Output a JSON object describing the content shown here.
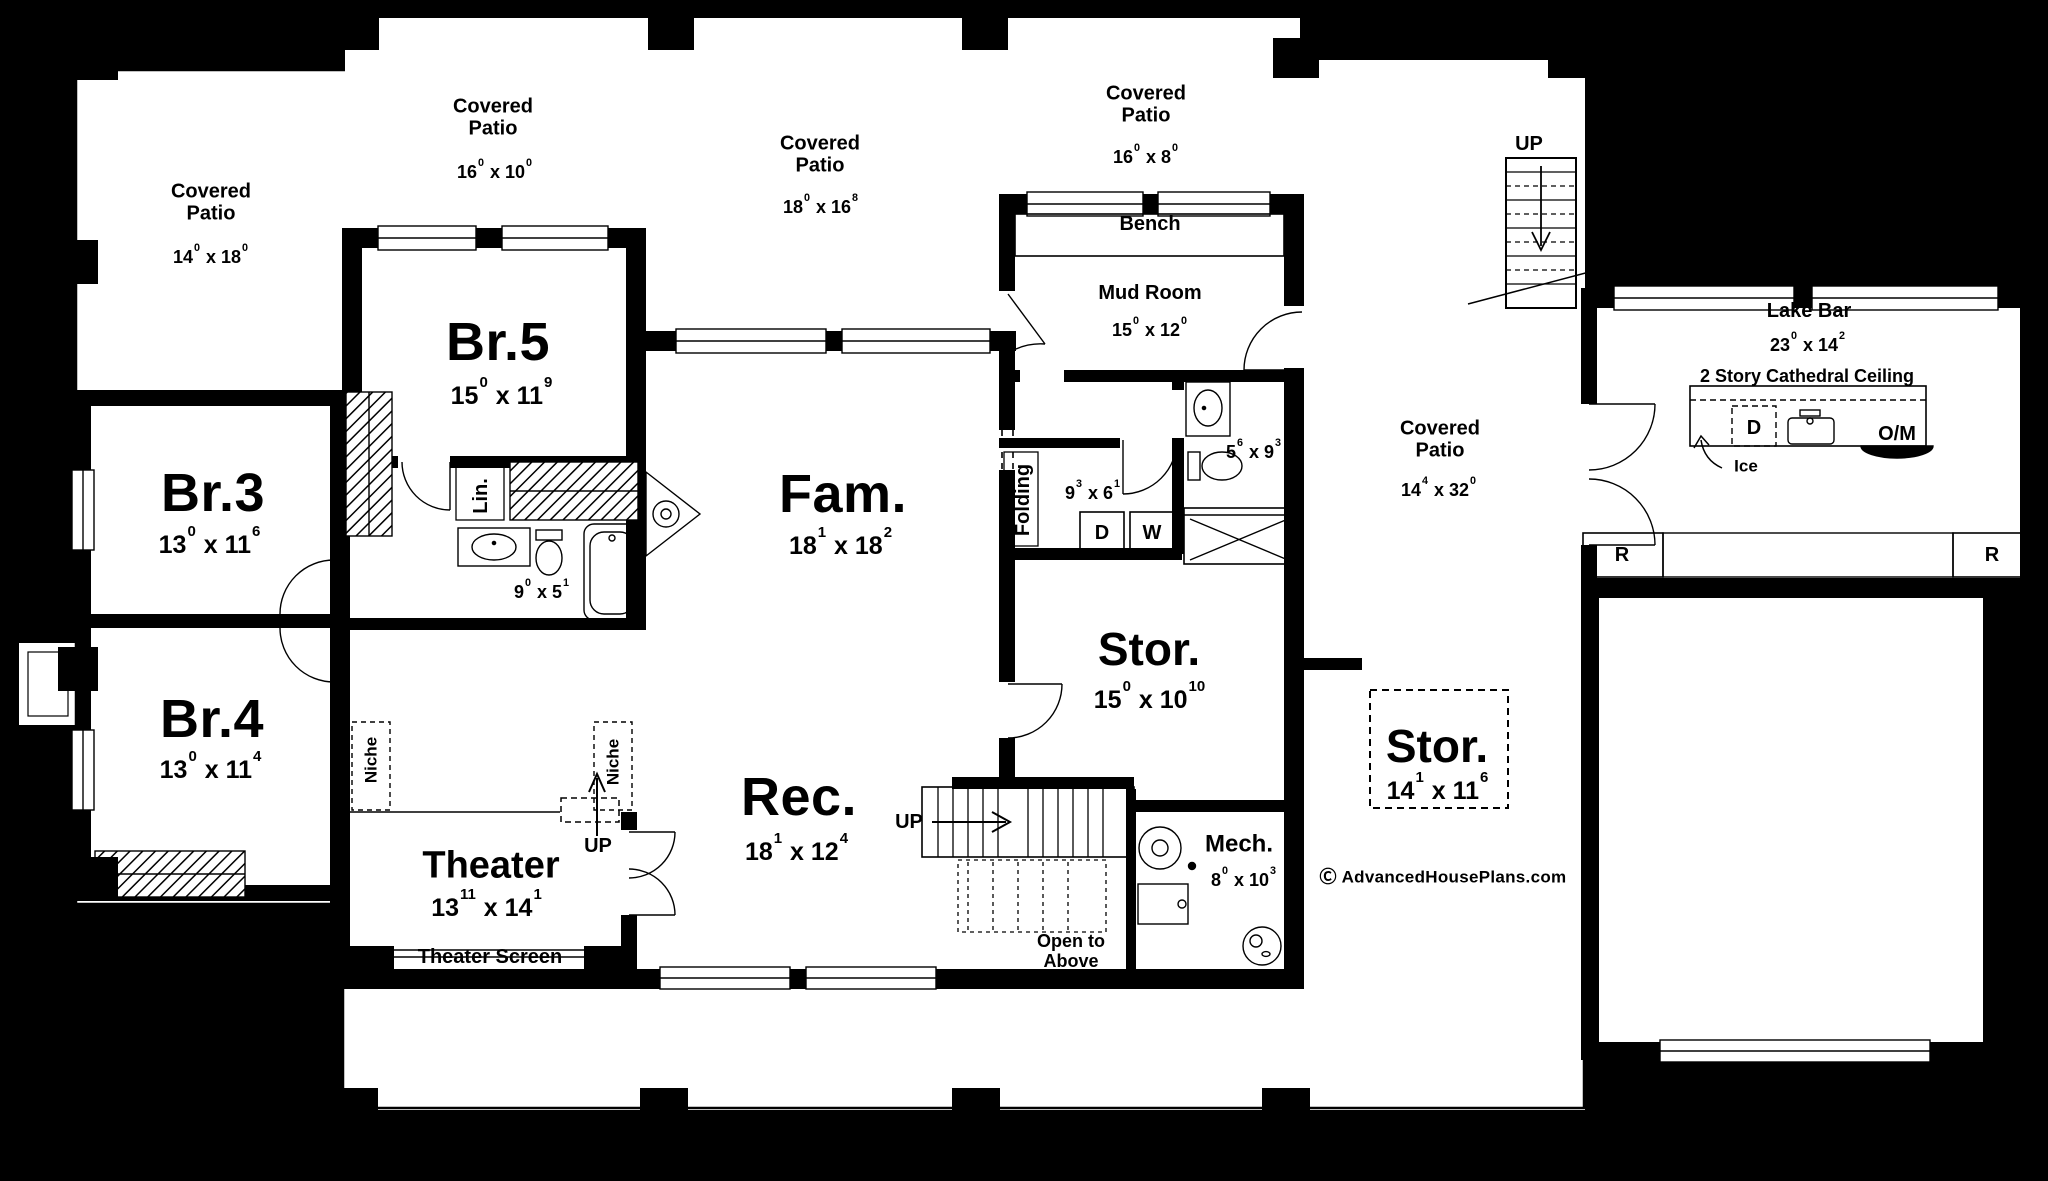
{
  "dim_sep": "x",
  "rooms": {
    "patio_tl": {
      "name": "Covered Patio",
      "a": "14",
      "as": "0",
      "b": "18",
      "bs": "0"
    },
    "patio_t1": {
      "name": "Covered Patio",
      "a": "16",
      "as": "0",
      "b": "10",
      "bs": "0"
    },
    "patio_t2": {
      "name": "Covered Patio",
      "a": "18",
      "as": "0",
      "b": "16",
      "bs": "8"
    },
    "patio_t3": {
      "name": "Covered Patio",
      "a": "16",
      "as": "0",
      "b": "8",
      "bs": "0"
    },
    "patio_r": {
      "name": "Covered Patio",
      "a": "14",
      "as": "4",
      "b": "32",
      "bs": "0"
    },
    "br5": {
      "name": "Br.5",
      "a": "15",
      "as": "0",
      "b": "11",
      "bs": "9"
    },
    "br3": {
      "name": "Br.3",
      "a": "13",
      "as": "0",
      "b": "11",
      "bs": "6"
    },
    "br4": {
      "name": "Br.4",
      "a": "13",
      "as": "0",
      "b": "11",
      "bs": "4"
    },
    "bath1": {
      "a": "9",
      "as": "0",
      "b": "5",
      "bs": "1"
    },
    "fam": {
      "name": "Fam.",
      "a": "18",
      "as": "1",
      "b": "18",
      "bs": "2"
    },
    "rec": {
      "name": "Rec.",
      "a": "18",
      "as": "1",
      "b": "12",
      "bs": "4"
    },
    "theater": {
      "name": "Theater",
      "a": "13",
      "as": "11",
      "b": "14",
      "bs": "1"
    },
    "mud": {
      "name": "Mud Room",
      "a": "15",
      "as": "0",
      "b": "12",
      "bs": "0"
    },
    "bath2": {
      "a": "5",
      "as": "6",
      "b": "9",
      "bs": "3"
    },
    "laundry": {
      "a": "9",
      "as": "3",
      "b": "6",
      "bs": "1"
    },
    "stor1": {
      "name": "Stor.",
      "a": "15",
      "as": "0",
      "b": "10",
      "bs": "10"
    },
    "stor2": {
      "name": "Stor.",
      "a": "14",
      "as": "1",
      "b": "11",
      "bs": "6"
    },
    "mech": {
      "name": "Mech.",
      "a": "8",
      "as": "0",
      "b": "10",
      "bs": "3"
    },
    "lakebar": {
      "name": "Lake Bar",
      "a": "23",
      "as": "0",
      "b": "14",
      "bs": "2",
      "note": "2 Story Cathedral Ceiling"
    }
  },
  "labels": {
    "bench": "Bench",
    "folding": "Folding",
    "lin": "Lin.",
    "niche": "Niche",
    "theater_screen": "Theater Screen",
    "open_above": "Open to Above",
    "up": "UP",
    "ice": "Ice",
    "dishwasher": "D",
    "dryer": "D",
    "washer": "W",
    "fridge": "R",
    "oven_micro": "O/M"
  },
  "branding": {
    "symbol": "Ⓒ",
    "text": "AdvancedHousePlans.com"
  },
  "colors": {
    "ink": "#000000",
    "paper": "#ffffff"
  }
}
